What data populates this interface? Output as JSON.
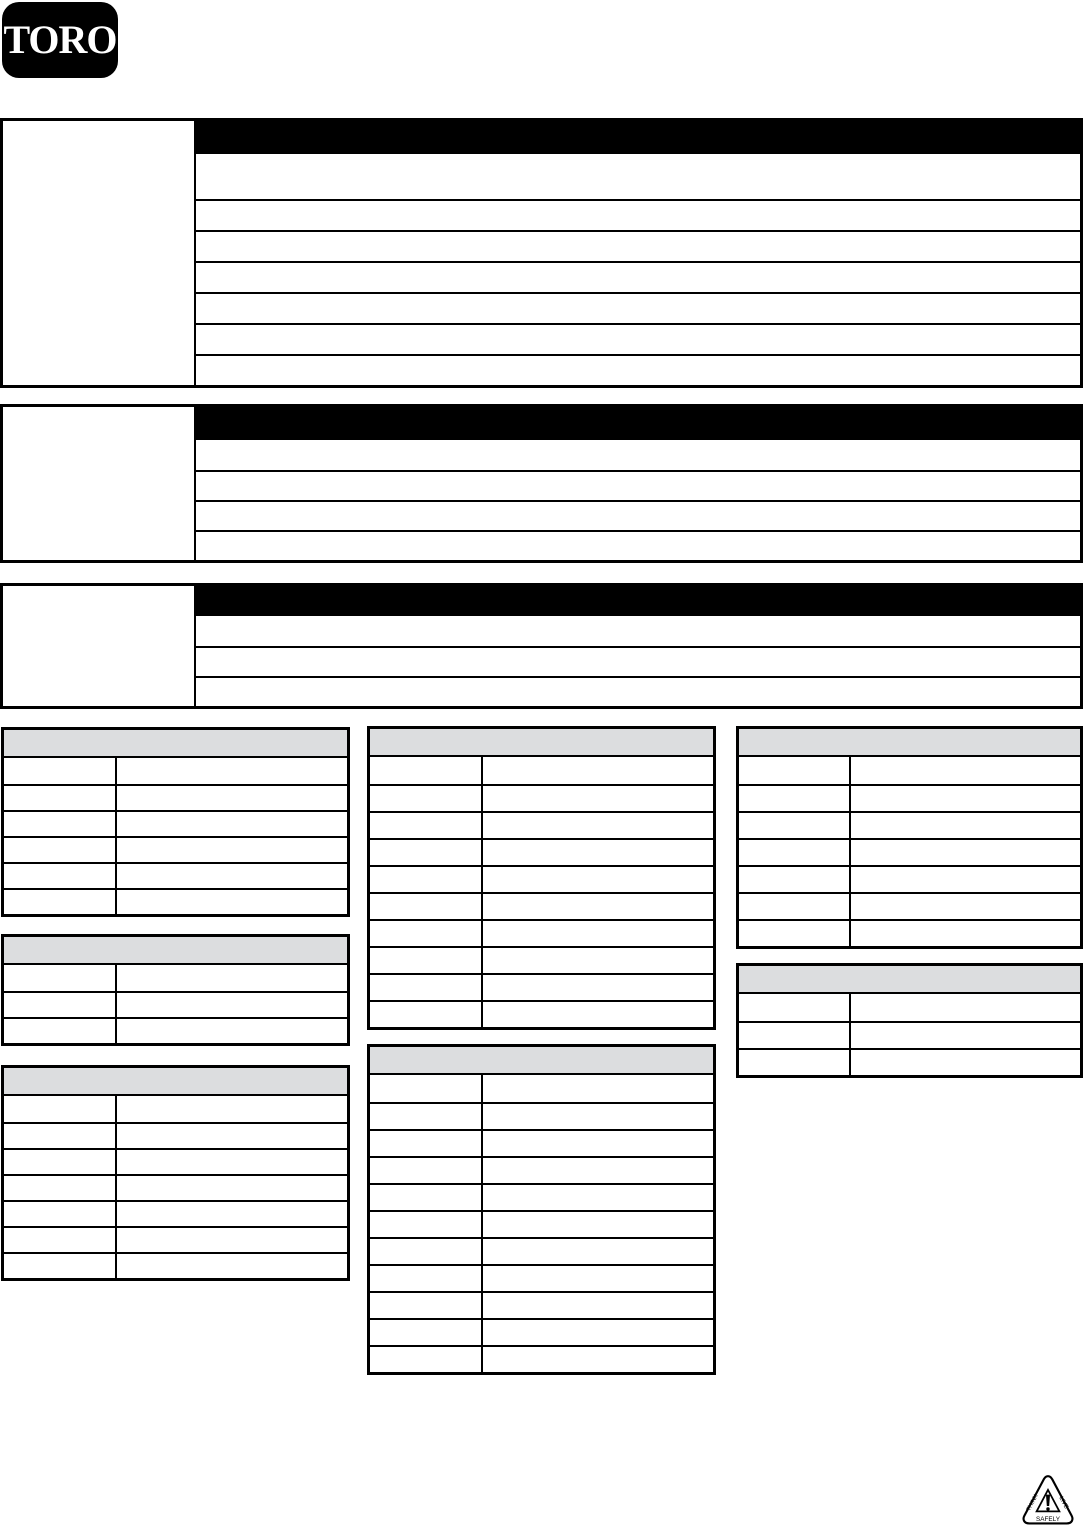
{
  "brand": {
    "logo_text": "TORO",
    "registered_mark": "®",
    "logo_background": "#000000",
    "logo_text_color": "#ffffff"
  },
  "colors": {
    "spec_header_bg": "#000000",
    "parts_header_bg": "#dcdddf",
    "table_border": "#000000",
    "page_background": "#ffffff"
  },
  "spec_tables": [
    {
      "name": "spec-table-1",
      "header_text": "",
      "side_cell_text": "",
      "rows": [
        "",
        "",
        "",
        "",
        "",
        "",
        ""
      ]
    },
    {
      "name": "spec-table-2",
      "header_text": "",
      "side_cell_text": "",
      "rows": [
        "",
        "",
        "",
        ""
      ]
    },
    {
      "name": "spec-table-3",
      "header_text": "",
      "side_cell_text": "",
      "rows": [
        "",
        "",
        ""
      ]
    }
  ],
  "parts_tables": [
    {
      "name": "parts-table-1",
      "header_text": "",
      "rows": [
        [
          "",
          ""
        ],
        [
          "",
          ""
        ],
        [
          "",
          ""
        ],
        [
          "",
          ""
        ],
        [
          "",
          ""
        ],
        [
          "",
          ""
        ]
      ]
    },
    {
      "name": "parts-table-2",
      "header_text": "",
      "rows": [
        [
          "",
          ""
        ],
        [
          "",
          ""
        ],
        [
          "",
          ""
        ]
      ]
    },
    {
      "name": "parts-table-3",
      "header_text": "",
      "rows": [
        [
          "",
          ""
        ],
        [
          "",
          ""
        ],
        [
          "",
          ""
        ],
        [
          "",
          ""
        ],
        [
          "",
          ""
        ],
        [
          "",
          ""
        ],
        [
          "",
          ""
        ]
      ]
    },
    {
      "name": "parts-table-4",
      "header_text": "",
      "rows": [
        [
          "",
          ""
        ],
        [
          "",
          ""
        ],
        [
          "",
          ""
        ],
        [
          "",
          ""
        ],
        [
          "",
          ""
        ],
        [
          "",
          ""
        ],
        [
          "",
          ""
        ],
        [
          "",
          ""
        ],
        [
          "",
          ""
        ],
        [
          "",
          ""
        ]
      ]
    },
    {
      "name": "parts-table-5",
      "header_text": "",
      "rows": [
        [
          "",
          ""
        ],
        [
          "",
          ""
        ],
        [
          "",
          ""
        ],
        [
          "",
          ""
        ],
        [
          "",
          ""
        ],
        [
          "",
          ""
        ],
        [
          "",
          ""
        ],
        [
          "",
          ""
        ],
        [
          "",
          ""
        ],
        [
          "",
          ""
        ],
        [
          "",
          ""
        ]
      ]
    },
    {
      "name": "parts-table-6",
      "header_text": "",
      "rows": [
        [
          "",
          ""
        ],
        [
          "",
          ""
        ],
        [
          "",
          ""
        ],
        [
          "",
          ""
        ],
        [
          "",
          ""
        ],
        [
          "",
          ""
        ],
        [
          "",
          ""
        ]
      ]
    },
    {
      "name": "parts-table-7",
      "header_text": "",
      "rows": [
        [
          "",
          ""
        ],
        [
          "",
          ""
        ],
        [
          "",
          ""
        ]
      ]
    }
  ],
  "safety_logo": {
    "left_text": "THINK",
    "right_text": "LIVE",
    "bottom_text": "SAFELY"
  }
}
